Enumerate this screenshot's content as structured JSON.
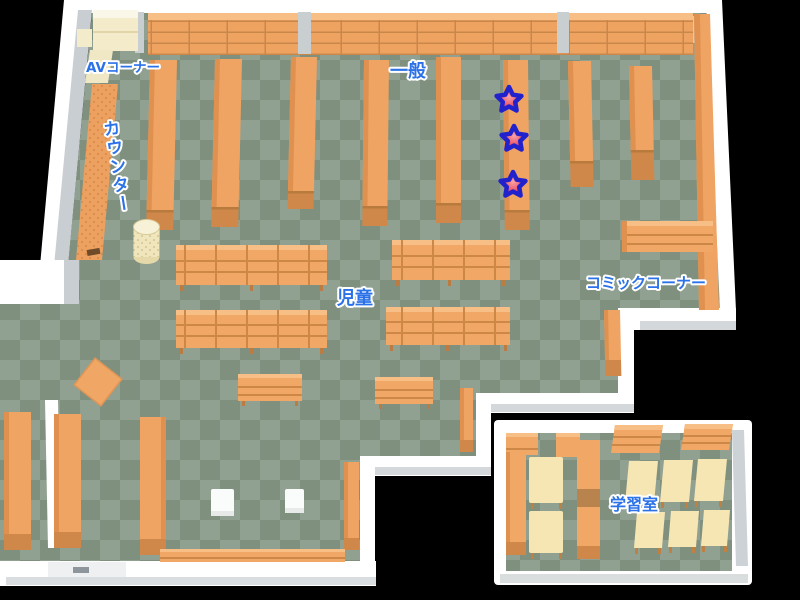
{
  "map": {
    "areas": [
      {
        "id": "av-corner",
        "label": "AVコーナー"
      },
      {
        "id": "counter",
        "label": "カウンター"
      },
      {
        "id": "general",
        "label": "一般"
      },
      {
        "id": "children",
        "label": "児童"
      },
      {
        "id": "comic-corner",
        "label": "コミックコーナー"
      },
      {
        "id": "study-room",
        "label": "学習室"
      }
    ],
    "stars": [
      {
        "transform": "translate(509,100)"
      },
      {
        "transform": "translate(514,139)"
      },
      {
        "transform": "translate(513,185)"
      }
    ],
    "colors": {
      "background": "#000000",
      "floor_light": "#91A191",
      "floor_dark": "#7F907F",
      "shelf_orange": "#F1A765",
      "shelf_front": "#CF884A",
      "wall_white": "#FFFFFF",
      "wall_shadow": "#C9CED2",
      "cream": "#F3EBC9",
      "table_cream": "#F6E6B4",
      "label_blue": "#2B72E8",
      "star_fill": "#EC5A6A",
      "star_outline": "#2222CC"
    }
  }
}
